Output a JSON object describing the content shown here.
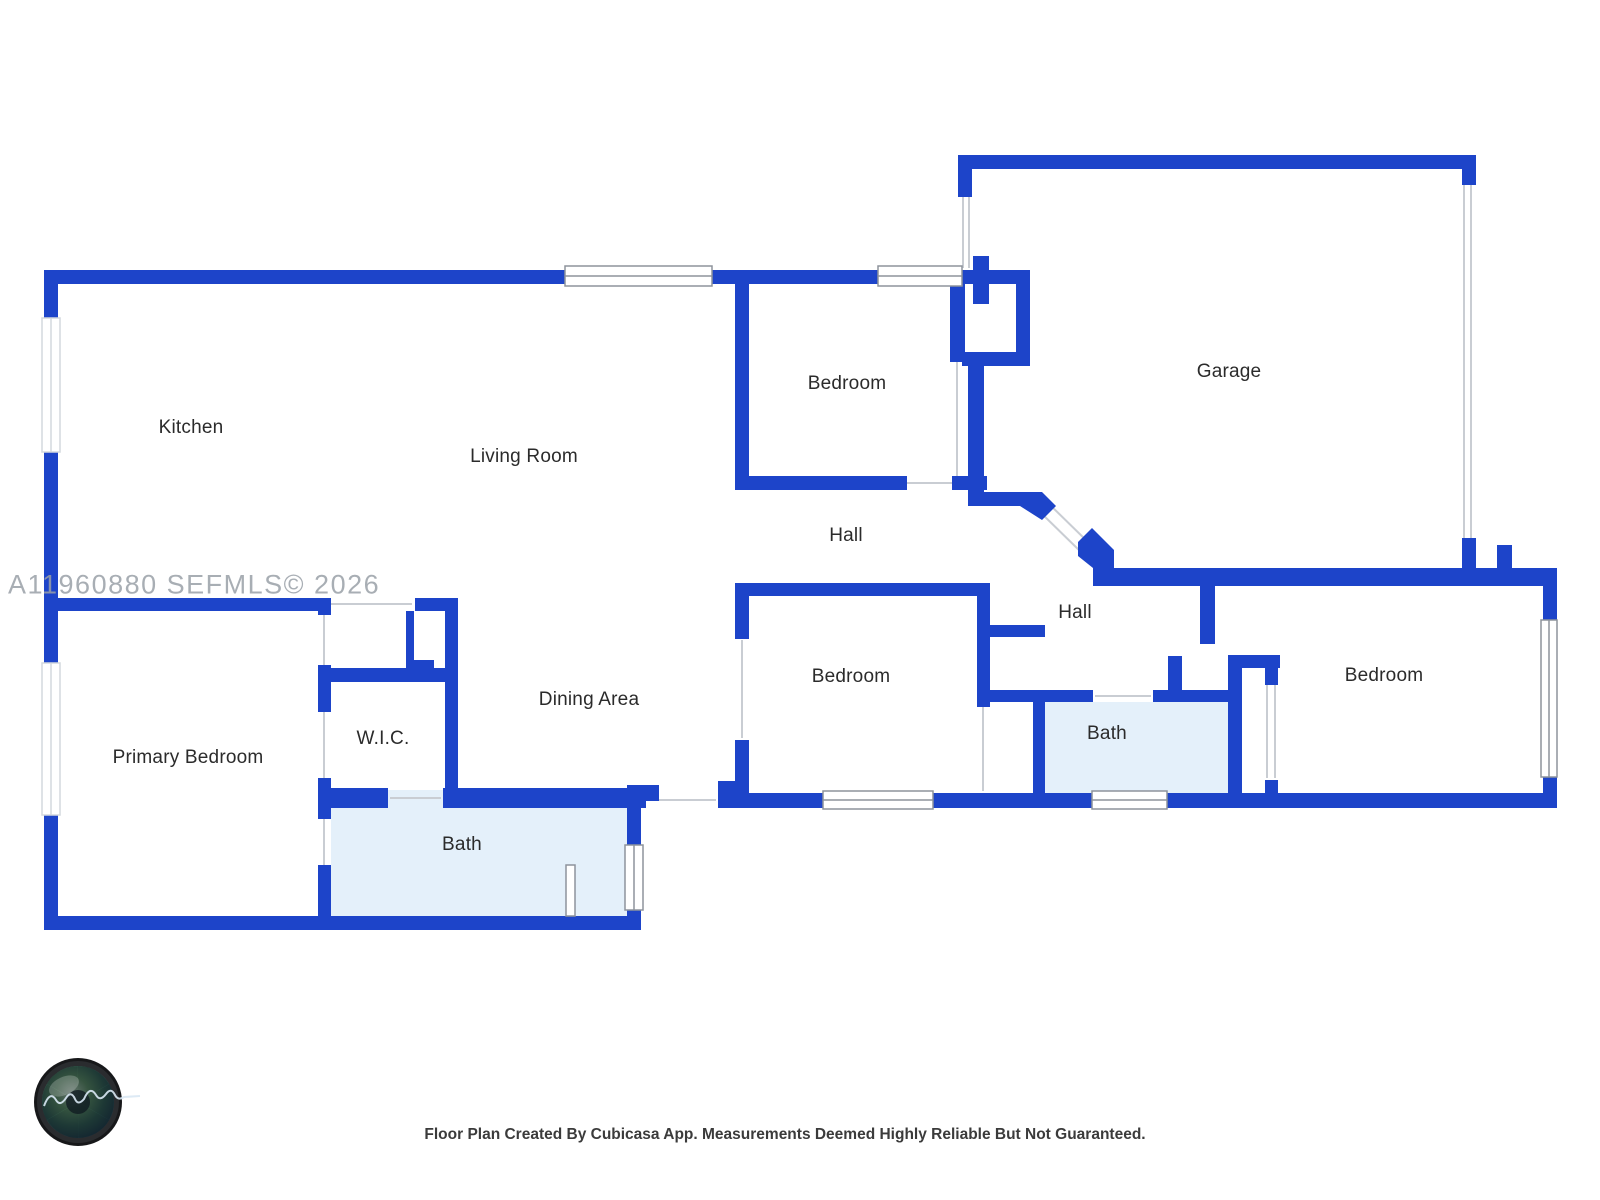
{
  "watermark": {
    "text": "A11960880  SEFMLS© 2026"
  },
  "footer": {
    "caption": "Floor Plan Created By Cubicasa App. Measurements Deemed Highly Reliable But Not Guaranteed."
  },
  "branding": {
    "logo_icon": "camera-lens-logo"
  },
  "palette": {
    "wall_blue": "#1d44c9",
    "bath_fill": "#e4f0fa",
    "label_text": "#2b2b2b",
    "watermark_gray": "#9aa0a8",
    "opening_gray": "#c9cdd3"
  },
  "rooms": [
    {
      "label": "Kitchen"
    },
    {
      "label": "Living Room"
    },
    {
      "label": "Bedroom"
    },
    {
      "label": "Garage"
    },
    {
      "label": "Hall"
    },
    {
      "label": "Hall"
    },
    {
      "label": "Bedroom"
    },
    {
      "label": "Bath"
    },
    {
      "label": "Bedroom"
    },
    {
      "label": "Primary Bedroom"
    },
    {
      "label": "W.I.C."
    },
    {
      "label": "Dining Area"
    },
    {
      "label": "Bath"
    }
  ]
}
